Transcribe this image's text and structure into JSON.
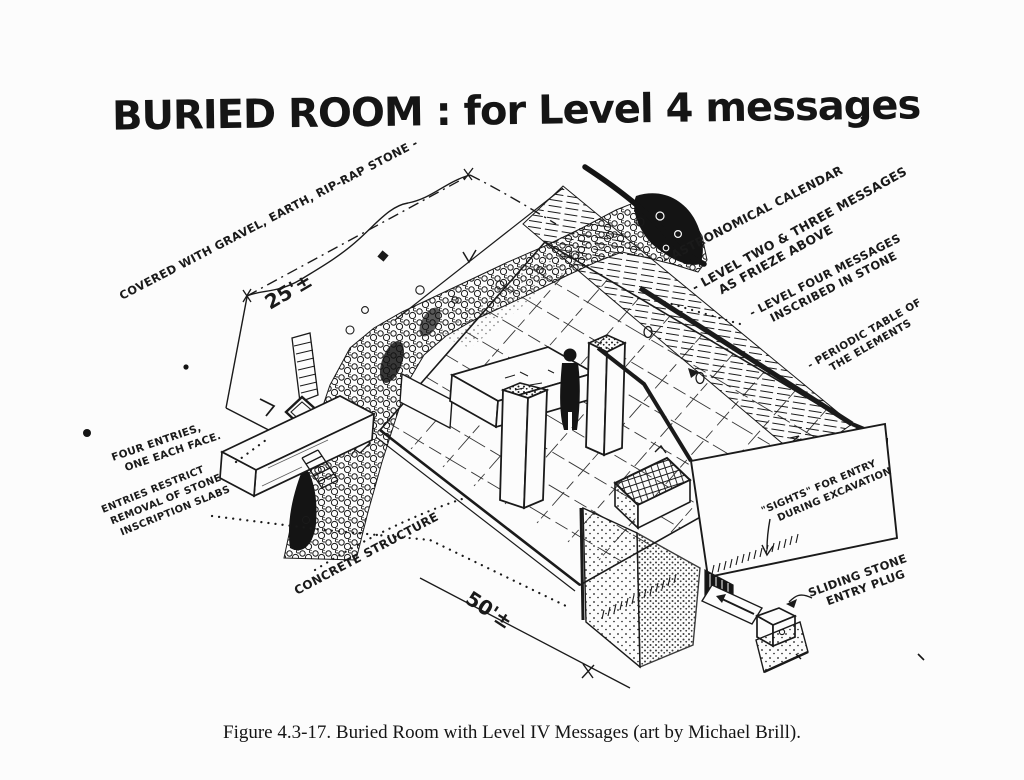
{
  "page": {
    "background": "#fcfcfc",
    "ink": "#1a1a1a"
  },
  "title": "BURIED ROOM : for Level 4 messages",
  "caption": "Figure 4.3-17.  Buried Room with Level IV Messages (art by Michael Brill).",
  "annotations": {
    "covered": "COVERED WITH GRAVEL, EARTH, RIP-RAP STONE -",
    "dim_25": "25'±",
    "dim_50": "50'±",
    "astronomical": "- ASTRONOMICAL CALENDAR",
    "level_two_three_1": "- LEVEL TWO & THREE MESSAGES",
    "level_two_three_2": "AS FRIEZE ABOVE",
    "level_four_1": "- LEVEL FOUR MESSAGES",
    "level_four_2": "INSCRIBED IN STONE",
    "periodic_1": "- PERIODIC TABLE OF",
    "periodic_2": "THE ELEMENTS",
    "four_entries_1": "FOUR ENTRIES,",
    "four_entries_2": "ONE EACH FACE.",
    "entries_restrict_1": "ENTRIES RESTRICT",
    "entries_restrict_2": "REMOVAL OF STONE",
    "entries_restrict_3": "INSCRIPTION SLABS",
    "concrete": "CONCRETE STRUCTURE",
    "sights_1": "\"SIGHTS\" FOR ENTRY",
    "sights_2": "DURING EXCAVATION",
    "sliding_1": "SLIDING STONE",
    "sliding_2": "ENTRY PLUG"
  }
}
